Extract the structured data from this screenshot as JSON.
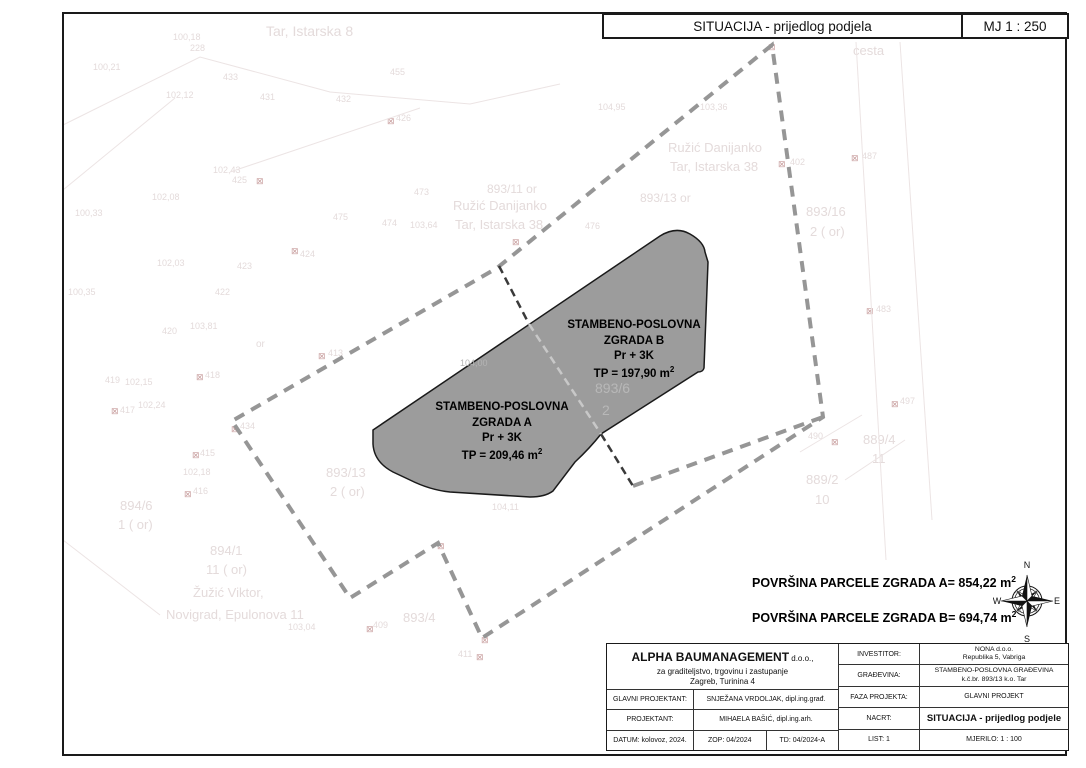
{
  "header": {
    "title": "SITUACIJA - prijedlog podjela",
    "scale": "MJ 1 : 250"
  },
  "buildings": {
    "b": {
      "line1": "STAMBENO-POSLOVNA",
      "line2": "ZGRADA B",
      "line3": "Pr + 3K",
      "area": "TP = 197,90 m",
      "area_sup": "2"
    },
    "a": {
      "line1": "STAMBENO-POSLOVNA",
      "line2": "ZGRADA A",
      "line3": "Pr + 3K",
      "area": "TP = 209,46 m",
      "area_sup": "2"
    }
  },
  "parcel_areas": {
    "a": "POVRŠINA PARCELE ZGRADA A= 854,22 m",
    "a_sup": "2",
    "b": "POVRŠINA PARCELE ZGRADA B= 694,74 m",
    "b_sup": "2"
  },
  "compass": {
    "n": "N",
    "e": "E",
    "s": "S",
    "w": "W",
    "nw": "NW",
    "ne": "NE",
    "sw": "SW",
    "se": "SE"
  },
  "titleblock": {
    "company": {
      "name": "ALPHA BAUMANAGEMENT",
      "suffix": " d.o.o.,",
      "line2": "za  graditeljstvo, trgovinu i zastupanje",
      "line3": "Zagreb, Turinina 4"
    },
    "left_rows": [
      {
        "label": "GLAVNI PROJEKTANT:",
        "value": "SNJEŽANA VRDOLJAK, dipl.ing.građ."
      },
      {
        "label": "PROJEKTANT:",
        "value": "MIHAELA BAŠIĆ, dipl.ing.arh."
      }
    ],
    "date_row": {
      "datum": "DATUM: kolovoz, 2024.",
      "zop": "ZOP: 04/2024",
      "td": "TD: 04/2024-A"
    },
    "right_rows": [
      {
        "label": "INVESTITOR:",
        "value1": "NONA d.o.o.",
        "value2": "Republika 5, Vabriga"
      },
      {
        "label": "GRAĐEVINA:",
        "value1": "STAMBENO-POSLOVNA GRAĐEVINA",
        "value2": "k.č.br. 893/13 k.o. Tar"
      },
      {
        "label": "FAZA PROJEKTA:",
        "value": "GLAVNI PROJEKT"
      },
      {
        "label": "NACRT:",
        "value": "SITUACIJA - prijedlog podjele"
      },
      {
        "label": "LIST: 1",
        "value": "MJERILO: 1 : 100"
      }
    ]
  },
  "colors": {
    "building_fill": "#9C9C9C",
    "boundary_dash": "#969696",
    "division_dash": "#3A3A3A",
    "faint_text": "#E4DBDB",
    "marker": "#C9A0A0"
  },
  "cadastral_labels": [
    {
      "t": "Tar, Istarska 8",
      "x": 266,
      "y": 24,
      "s": 14
    },
    {
      "t": "100,18",
      "x": 173,
      "y": 33,
      "s": 9
    },
    {
      "t": "228",
      "x": 190,
      "y": 44,
      "s": 9
    },
    {
      "t": "100,21",
      "x": 93,
      "y": 63,
      "s": 9
    },
    {
      "t": "433",
      "x": 223,
      "y": 73,
      "s": 9
    },
    {
      "t": "455",
      "x": 390,
      "y": 68,
      "s": 9
    },
    {
      "t": "102,12",
      "x": 166,
      "y": 91,
      "s": 9
    },
    {
      "t": "431",
      "x": 260,
      "y": 93,
      "s": 9
    },
    {
      "t": "432",
      "x": 336,
      "y": 95,
      "s": 9
    },
    {
      "t": "426",
      "x": 396,
      "y": 114,
      "s": 9
    },
    {
      "t": "cesta",
      "x": 853,
      "y": 44,
      "s": 13
    },
    {
      "t": "104,95",
      "x": 598,
      "y": 103,
      "s": 9
    },
    {
      "t": "103,36",
      "x": 700,
      "y": 103,
      "s": 9
    },
    {
      "t": "Ružić Danijanko",
      "x": 668,
      "y": 141,
      "s": 13
    },
    {
      "t": "Tar, Istarska 38",
      "x": 670,
      "y": 160,
      "s": 13
    },
    {
      "t": "402",
      "x": 790,
      "y": 158,
      "s": 9
    },
    {
      "t": "487",
      "x": 862,
      "y": 152,
      "s": 9
    },
    {
      "t": "102,43",
      "x": 213,
      "y": 166,
      "s": 9
    },
    {
      "t": "425",
      "x": 232,
      "y": 176,
      "s": 9
    },
    {
      "t": "102,08",
      "x": 152,
      "y": 193,
      "s": 9
    },
    {
      "t": "893/13 or",
      "x": 640,
      "y": 192,
      "s": 12
    },
    {
      "t": "100,33",
      "x": 75,
      "y": 209,
      "s": 9
    },
    {
      "t": "893/16",
      "x": 806,
      "y": 205,
      "s": 13
    },
    {
      "t": "2 ( or)",
      "x": 810,
      "y": 225,
      "s": 13
    },
    {
      "t": "473",
      "x": 414,
      "y": 188,
      "s": 9
    },
    {
      "t": "893/11 or",
      "x": 487,
      "y": 183,
      "s": 12
    },
    {
      "t": "Ružić Danijanko",
      "x": 453,
      "y": 199,
      "s": 13
    },
    {
      "t": "Tar, Istarska 38",
      "x": 455,
      "y": 218,
      "s": 13
    },
    {
      "t": "474",
      "x": 382,
      "y": 219,
      "s": 9
    },
    {
      "t": "103,64",
      "x": 410,
      "y": 221,
      "s": 9
    },
    {
      "t": "476",
      "x": 585,
      "y": 222,
      "s": 9
    },
    {
      "t": "475",
      "x": 333,
      "y": 213,
      "s": 9
    },
    {
      "t": "424",
      "x": 300,
      "y": 250,
      "s": 9
    },
    {
      "t": "102,03",
      "x": 157,
      "y": 259,
      "s": 9
    },
    {
      "t": "423",
      "x": 237,
      "y": 262,
      "s": 9
    },
    {
      "t": "100,35",
      "x": 68,
      "y": 288,
      "s": 9
    },
    {
      "t": "422",
      "x": 215,
      "y": 288,
      "s": 9
    },
    {
      "t": "420",
      "x": 162,
      "y": 327,
      "s": 9
    },
    {
      "t": "103,81",
      "x": 190,
      "y": 322,
      "s": 9
    },
    {
      "t": "or",
      "x": 256,
      "y": 340,
      "s": 10
    },
    {
      "t": "413",
      "x": 328,
      "y": 349,
      "s": 9
    },
    {
      "t": "419",
      "x": 105,
      "y": 376,
      "s": 9
    },
    {
      "t": "102,15",
      "x": 125,
      "y": 378,
      "s": 9
    },
    {
      "t": "418",
      "x": 205,
      "y": 371,
      "s": 9
    },
    {
      "t": "417",
      "x": 120,
      "y": 406,
      "s": 9
    },
    {
      "t": "102,24",
      "x": 138,
      "y": 401,
      "s": 9
    },
    {
      "t": "434",
      "x": 240,
      "y": 422,
      "s": 9
    },
    {
      "t": "889/4",
      "x": 863,
      "y": 433,
      "s": 13
    },
    {
      "t": "11",
      "x": 872,
      "y": 452,
      "s": 13
    },
    {
      "t": "497",
      "x": 900,
      "y": 397,
      "s": 9
    },
    {
      "t": "490",
      "x": 808,
      "y": 432,
      "s": 9
    },
    {
      "t": "483",
      "x": 876,
      "y": 305,
      "s": 9
    },
    {
      "t": "415",
      "x": 200,
      "y": 449,
      "s": 9
    },
    {
      "t": "102,18",
      "x": 183,
      "y": 468,
      "s": 9
    },
    {
      "t": "416",
      "x": 193,
      "y": 487,
      "s": 9
    },
    {
      "t": "894/6",
      "x": 120,
      "y": 499,
      "s": 13
    },
    {
      "t": "1 ( or)",
      "x": 118,
      "y": 518,
      "s": 13
    },
    {
      "t": "893/13",
      "x": 326,
      "y": 466,
      "s": 13
    },
    {
      "t": "2 ( or)",
      "x": 330,
      "y": 485,
      "s": 13
    },
    {
      "t": "889/2",
      "x": 806,
      "y": 473,
      "s": 13
    },
    {
      "t": "10",
      "x": 815,
      "y": 493,
      "s": 13
    },
    {
      "t": "894/1",
      "x": 210,
      "y": 544,
      "s": 13
    },
    {
      "t": "11 ( or)",
      "x": 206,
      "y": 563,
      "s": 13
    },
    {
      "t": "Žužić Viktor,",
      "x": 193,
      "y": 586,
      "s": 13
    },
    {
      "t": "Novigrad, Epulonova 11",
      "x": 166,
      "y": 608,
      "s": 13
    },
    {
      "t": "103,04",
      "x": 288,
      "y": 623,
      "s": 9
    },
    {
      "t": "409",
      "x": 373,
      "y": 621,
      "s": 9
    },
    {
      "t": "893/4",
      "x": 403,
      "y": 611,
      "s": 13
    },
    {
      "t": "104,11",
      "x": 492,
      "y": 503,
      "s": 9
    },
    {
      "t": "411",
      "x": 458,
      "y": 650,
      "s": 9
    },
    {
      "t": "893/6",
      "x": 595,
      "y": 381,
      "s": 14,
      "c": "#b8b8b8",
      "top": true
    },
    {
      "t": "2",
      "x": 602,
      "y": 403,
      "s": 14,
      "c": "#b8b8b8",
      "top": true
    },
    {
      "t": "104,00",
      "x": 460,
      "y": 359,
      "s": 9,
      "c": "#b4b4b4",
      "top": true
    }
  ],
  "cadastral_markers": [
    [
      768,
      43
    ],
    [
      778,
      160
    ],
    [
      851,
      154
    ],
    [
      866,
      307
    ],
    [
      891,
      400
    ],
    [
      831,
      438
    ],
    [
      387,
      117
    ],
    [
      256,
      177
    ],
    [
      291,
      247
    ],
    [
      196,
      373
    ],
    [
      318,
      352
    ],
    [
      111,
      407
    ],
    [
      231,
      425
    ],
    [
      192,
      451
    ],
    [
      184,
      490
    ],
    [
      437,
      542
    ],
    [
      481,
      636
    ],
    [
      366,
      625
    ],
    [
      476,
      653
    ],
    [
      512,
      238
    ]
  ]
}
